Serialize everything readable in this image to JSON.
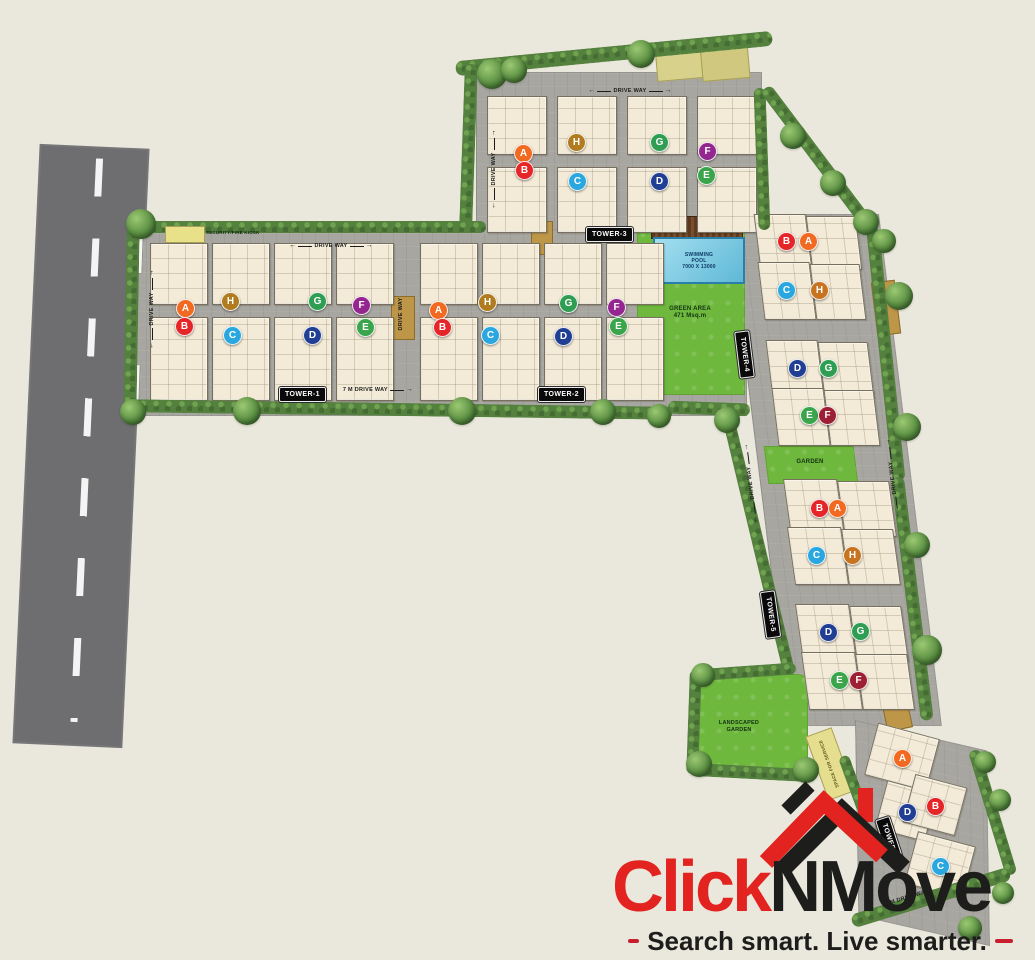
{
  "plan": {
    "towers": [
      {
        "name": "TOWER-1",
        "units": [
          "A",
          "B",
          "H",
          "C",
          "G",
          "D",
          "F",
          "E"
        ]
      },
      {
        "name": "TOWER-2",
        "units": [
          "A",
          "B",
          "H",
          "C",
          "G",
          "D",
          "F",
          "E"
        ]
      },
      {
        "name": "TOWER-3",
        "units": [
          "A",
          "B",
          "H",
          "C",
          "G",
          "D",
          "F",
          "E"
        ]
      },
      {
        "name": "TOWER-4",
        "units": [
          "B",
          "A",
          "C",
          "H",
          "D",
          "G",
          "E",
          "F"
        ]
      },
      {
        "name": "TOWER-5",
        "units": [
          "B",
          "A",
          "C",
          "H",
          "D",
          "G",
          "E",
          "F"
        ]
      },
      {
        "name": "TOWER-6",
        "units": [
          "A",
          "D",
          "B",
          "C"
        ]
      }
    ],
    "unit_colors": {
      "A": "#f26a21",
      "B": "#e52528",
      "C": "#2aa7df",
      "D": "#1f3e94",
      "E": "#3aa54a",
      "F": "#93278f",
      "F_alt": "#9d1f33",
      "G": "#2f9e52",
      "H": "#b07c1f",
      "H_alt": "#c8731f"
    },
    "areas": {
      "swimming_pool_line1": "SWIMMING",
      "swimming_pool_line2": "POOL",
      "swimming_pool_line3": "7000 X 13000",
      "green_area_line1": "GREEN AREA",
      "green_area_line2": "471 Msq.m",
      "garden": "GARDEN",
      "landscaped_garden_line1": "LANDSCAPED",
      "landscaped_garden_line2": "GARDEN",
      "space_for_service": "SPACE FOR SERVICE",
      "security_kiosk": "SECURITY/FIRE KIOSK"
    },
    "roads": {
      "drive_way": "DRIVE WAY",
      "drive_way_7m": "7 M DRIVE WAY"
    }
  },
  "icons": {
    "arrow_left": "←",
    "arrow_right": "→"
  },
  "logo": {
    "brand_red": "Click",
    "brand_black": "NMove",
    "brand_red_color": "#e2231f",
    "brand_black_color": "#1d1d1b",
    "tagline": "Search smart. Live smarter."
  }
}
